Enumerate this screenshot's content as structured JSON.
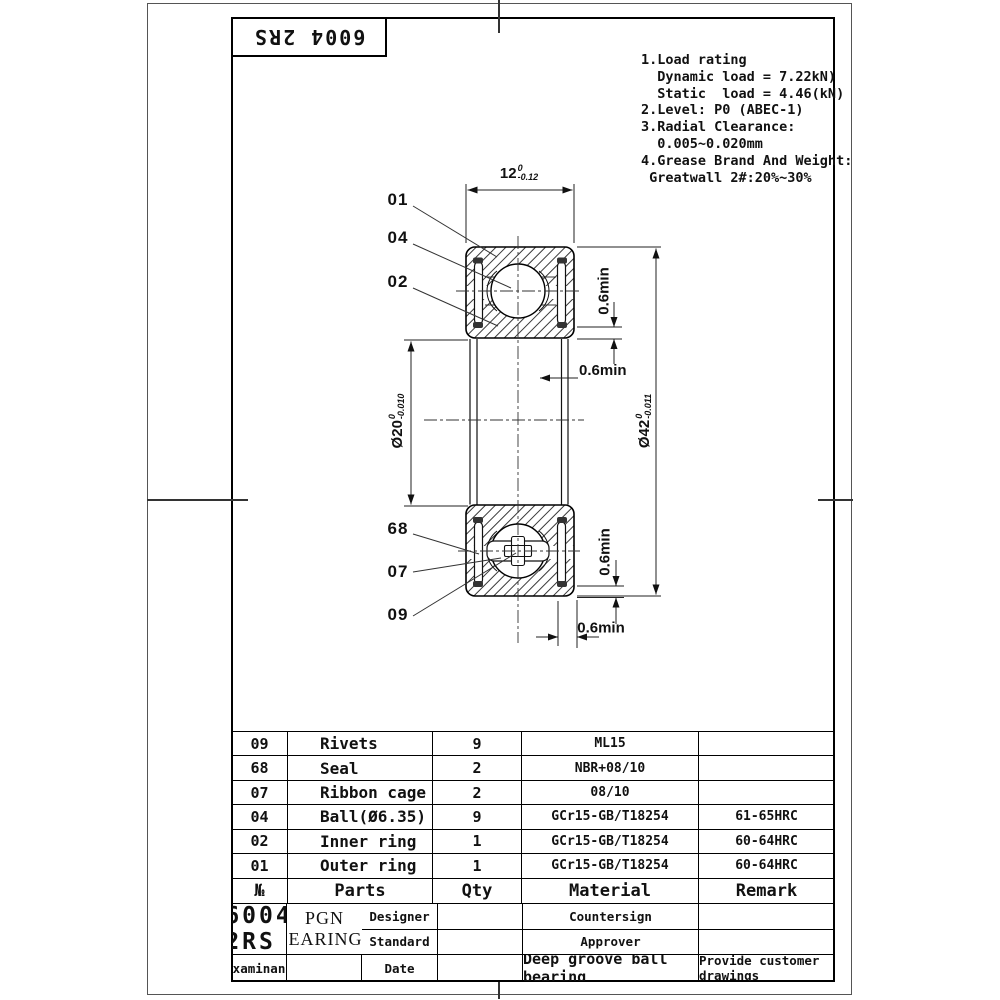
{
  "title_box": {
    "part_number": "6004 2RS"
  },
  "notes": {
    "lines": [
      "1.Load rating",
      "  Dynamic load = 7.22kN)",
      "  Static  load = 4.46(kN)",
      "2.Level: P0 (ABEC-1)",
      "3.Radial Clearance:",
      "  0.005~0.020mm",
      "4.Grease Brand And Weight:",
      " Greatwall 2#:20%~30%"
    ]
  },
  "drawing": {
    "callouts": [
      "01",
      "04",
      "02",
      "68",
      "07",
      "09"
    ],
    "dim_width": {
      "value": "12",
      "tol_upper": "0",
      "tol_lower": "-0.12"
    },
    "dim_bore": {
      "value": "Ø20",
      "tol_upper": "0",
      "tol_lower": "-0.010"
    },
    "dim_od": {
      "value": "Ø42",
      "tol_upper": "0",
      "tol_lower": "-0.011"
    },
    "dim_min": "0.6min"
  },
  "parts_table": {
    "headers": {
      "no": "№",
      "parts": "Parts",
      "qty": "Qty",
      "material": "Material",
      "remark": "Remark"
    },
    "rows": [
      {
        "no": "09",
        "part": "Rivets",
        "qty": "9",
        "material": "ML15",
        "remark": ""
      },
      {
        "no": "68",
        "part": "Seal",
        "qty": "2",
        "material": "NBR+08/10",
        "remark": ""
      },
      {
        "no": "07",
        "part": "Ribbon cage",
        "qty": "2",
        "material": "08/10",
        "remark": ""
      },
      {
        "no": "04",
        "part": "Ball(Ø6.35)",
        "qty": "9",
        "material": "GCr15-GB/T18254",
        "remark": "61-65HRC"
      },
      {
        "no": "02",
        "part": "Inner ring",
        "qty": "1",
        "material": "GCr15-GB/T18254",
        "remark": "60-64HRC"
      },
      {
        "no": "01",
        "part": "Outer ring",
        "qty": "1",
        "material": "GCr15-GB/T18254",
        "remark": "60-64HRC"
      }
    ]
  },
  "title_block": {
    "designer": "Designer",
    "countersign": "Countersign",
    "standard": "Standard",
    "approver": "Approver",
    "examinant": "Examinant",
    "date": "Date",
    "part_number": "6004 2RS",
    "product_name": "Deep groove ball bearing",
    "company_line1": "PGN",
    "company_line2": "BEARINGS",
    "remark": "Provide customer drawings"
  }
}
